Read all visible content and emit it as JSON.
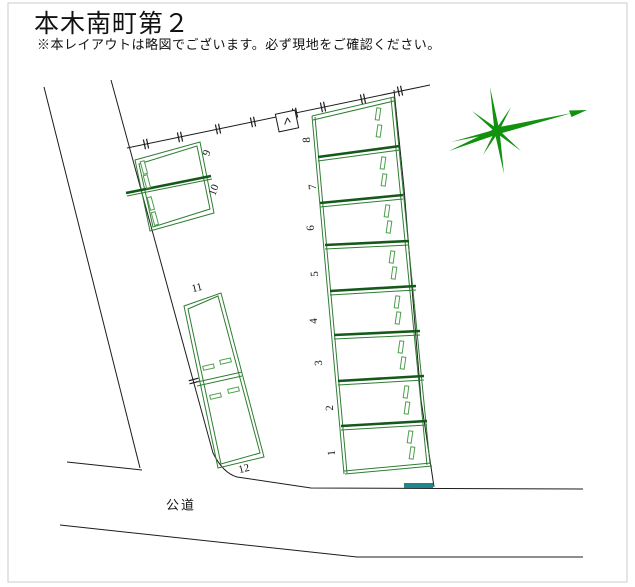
{
  "header": {
    "title": "本木南町第２",
    "disclaimer": "※本レイアウトは略図でございます。必ず現地をご確認ください。"
  },
  "plan": {
    "road_label": "公道",
    "spaces": [
      {
        "label": "1"
      },
      {
        "label": "2"
      },
      {
        "label": "3"
      },
      {
        "label": "4"
      },
      {
        "label": "5"
      },
      {
        "label": "6"
      },
      {
        "label": "7"
      },
      {
        "label": "8"
      },
      {
        "label": "9"
      },
      {
        "label": "10"
      },
      {
        "label": "11"
      },
      {
        "label": "12"
      }
    ],
    "colors": {
      "boundary": "#1c1c1c",
      "parking_line": "#2e7d32",
      "divider_dark": "#14591a",
      "marker_light": "#4d9e4d",
      "compass_green": "#12910f",
      "entrance_teal": "#20868c",
      "frame_gray": "#c9cdc9",
      "text": "#111111"
    }
  }
}
